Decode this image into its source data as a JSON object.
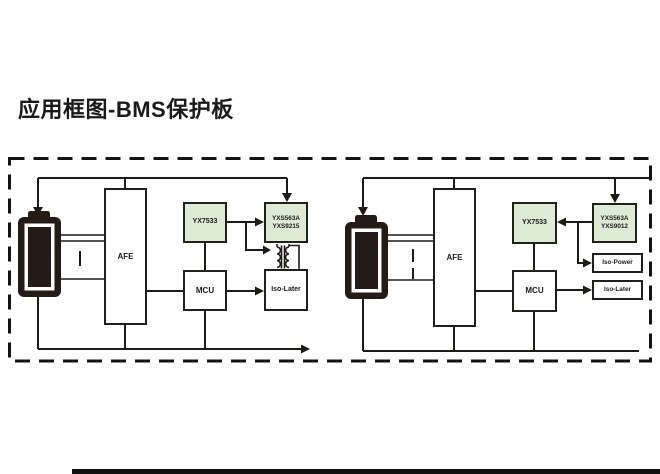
{
  "title": "应用框图-BMS保护板",
  "colors": {
    "chip_green": "#dcead6",
    "line": "#1d1b18",
    "battery": "#241b16"
  },
  "left_diagram": {
    "afe_label": "AFE",
    "ldo_label": "YX7533",
    "isolator_chip_line1": "YXS563A",
    "isolator_chip_line2": "YXS9215",
    "mcu_label": "MCU",
    "iso_later_label": "Iso-Later"
  },
  "right_diagram": {
    "afe_label": "AFE",
    "ldo_label": "YX7533",
    "isolator_chip_line1": "YXS563A",
    "isolator_chip_line2": "YXS9012",
    "mcu_label": "MCU",
    "iso_power_label": "Iso-Power",
    "iso_later_label": "Iso-Later"
  }
}
